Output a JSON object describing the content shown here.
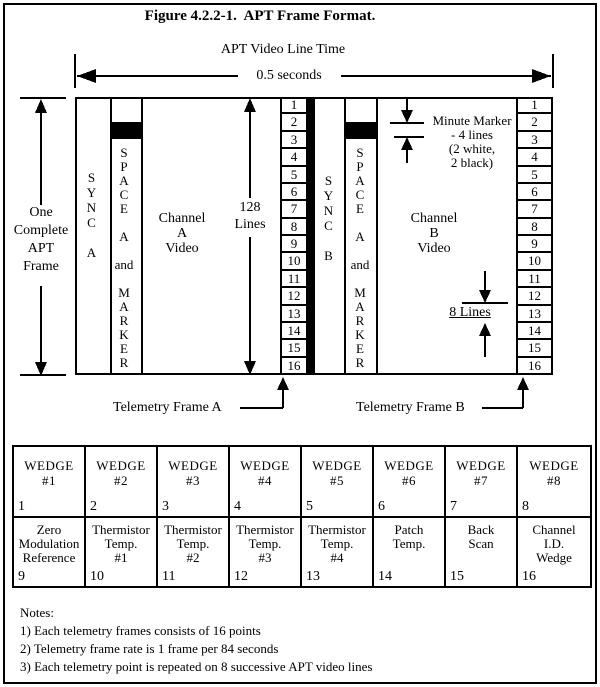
{
  "figure": {
    "title": "Figure 4.2.2-1.  APT Frame Format."
  },
  "timing": {
    "label": "APT Video Line Time",
    "duration": "0.5 seconds"
  },
  "frame": {
    "left_label": "One\nComplete\nAPT\nFrame",
    "lines_count_label": "128\nLines"
  },
  "channel_a": {
    "sync": "S\nY\nN\nC\n\nA",
    "space_marker": "S\nP\nA\nC\nE\n\nA\n\nand\n\nM\nA\nR\nK\nE\nR",
    "video": "Channel\nA\nVideo",
    "telemetry_label": "Telemetry Frame A"
  },
  "channel_b": {
    "sync": "S\nY\nN\nC\n\nB",
    "space_marker": "S\nP\nA\nC\nE\n\nA\n\nand\n\nM\nA\nR\nK\nE\nR",
    "video": "Channel\nB\nVideo",
    "telemetry_label": "Telemetry Frame B"
  },
  "annotations": {
    "minute_marker": "Minute Marker\n- 4 lines\n(2 white,\n2 black)",
    "eight_lines": "8 Lines"
  },
  "telemetry_rows": [
    "1",
    "2",
    "3",
    "4",
    "5",
    "6",
    "7",
    "8",
    "9",
    "10",
    "11",
    "12",
    "13",
    "14",
    "15",
    "16"
  ],
  "wedge_table": {
    "row1": [
      {
        "label": "WEDGE\n#1",
        "num": "1"
      },
      {
        "label": "WEDGE\n#2",
        "num": "2"
      },
      {
        "label": "WEDGE\n#3",
        "num": "3"
      },
      {
        "label": "WEDGE\n#4",
        "num": "4"
      },
      {
        "label": "WEDGE\n#5",
        "num": "5"
      },
      {
        "label": "WEDGE\n#6",
        "num": "6"
      },
      {
        "label": "WEDGE\n#7",
        "num": "7"
      },
      {
        "label": "WEDGE\n#8",
        "num": "8"
      }
    ],
    "row2": [
      {
        "label": "Zero\nModulation\nReference",
        "num": "9"
      },
      {
        "label": "Thermistor\nTemp.\n#1",
        "num": "10"
      },
      {
        "label": "Thermistor\nTemp.\n#2",
        "num": "11"
      },
      {
        "label": "Thermistor\nTemp.\n#3",
        "num": "12"
      },
      {
        "label": "Thermistor\nTemp.\n#4",
        "num": "13"
      },
      {
        "label": "Patch\nTemp.",
        "num": "14"
      },
      {
        "label": "Back\nScan",
        "num": "15"
      },
      {
        "label": "Channel\nI.D.\nWedge",
        "num": "16"
      }
    ]
  },
  "notes": {
    "title": "Notes:",
    "items": [
      "1) Each telemetry frames consists of 16 points",
      "2) Telemetry frame rate is 1 frame per 84 seconds",
      "3) Each telemetry point is repeated on 8 successive APT video lines"
    ]
  },
  "colors": {
    "ink": "#000000",
    "paper": "#ffffff"
  }
}
